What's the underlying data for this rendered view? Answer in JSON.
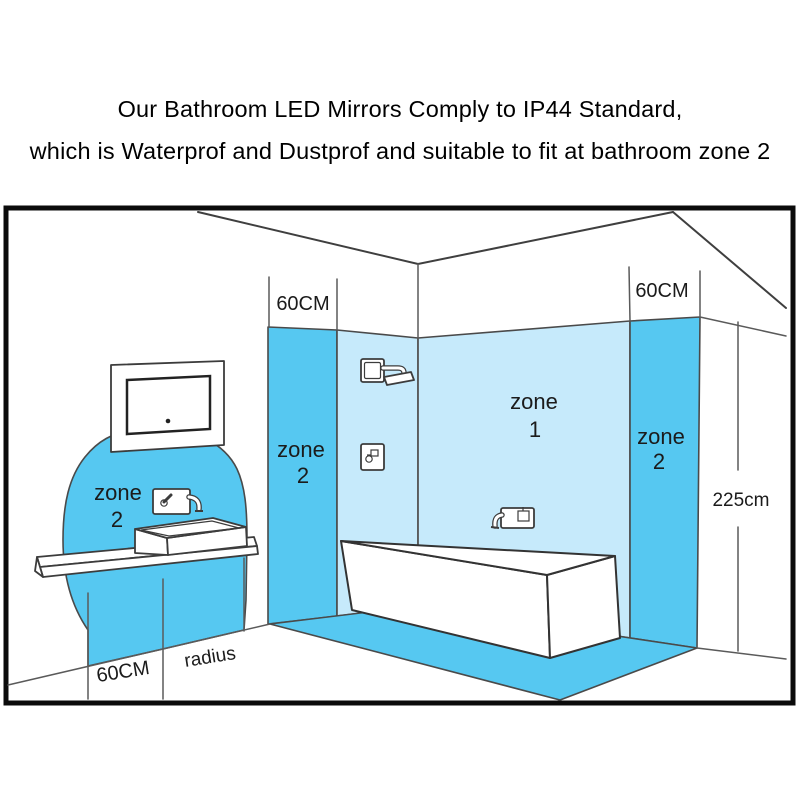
{
  "title": {
    "line1": "Our Bathroom LED Mirrors Comply to IP44 Standard,",
    "line2": "which is Waterprof and Dustprof and suitable to fit at bathroom zone 2"
  },
  "diagram": {
    "labels": {
      "zone2_basin": {
        "word": "zone",
        "num": "2"
      },
      "zone2_left_wall": {
        "word": "zone",
        "num": "2"
      },
      "zone1_bath": {
        "word": "zone",
        "num": "1"
      },
      "zone2_right_wall": {
        "word": "zone",
        "num": "2"
      },
      "top_60cm_left": "60CM",
      "top_60cm_right": "60CM",
      "wall_height": "225cm",
      "floor_60cm": "60CM",
      "floor_radius": "radius"
    },
    "colors": {
      "zone_strong_blue": "#56c8f1",
      "zone_light_blue": "#c6eafb",
      "outline_gray": "#474747",
      "frame_black": "#0b0b0b",
      "label_text": "#1b1b1b",
      "background": "#ffffff"
    }
  }
}
